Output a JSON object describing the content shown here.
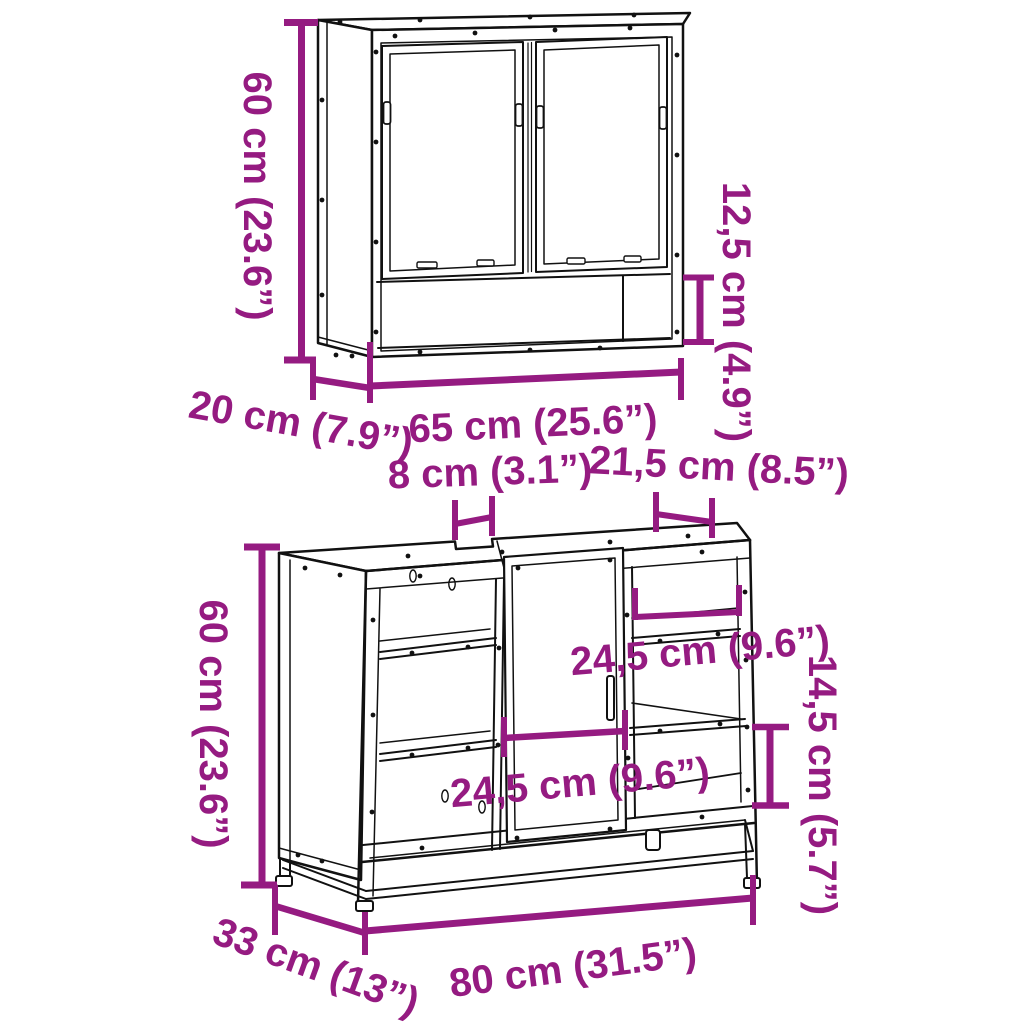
{
  "colors": {
    "dimension": "#951B81",
    "outline": "#111111",
    "background": "#ffffff"
  },
  "mirror": {
    "height": "60 cm (23.6”)",
    "depth": "20 cm (7.9”)",
    "width": "65 cm (25.6”)",
    "shelf_height": "12,5 cm (4.9”)"
  },
  "vanity": {
    "height": "60 cm (23.6”)",
    "notch_width": "8 cm (3.1”)",
    "top_opening_width": "21,5 cm (8.5”)",
    "shelf_width": "24,5 cm (9.6”)",
    "shelf_height": "14,5 cm (5.7”)",
    "door_width": "24,5 cm (9.6”)",
    "depth": "33 cm (13”)",
    "width": "80 cm (31.5”)"
  }
}
